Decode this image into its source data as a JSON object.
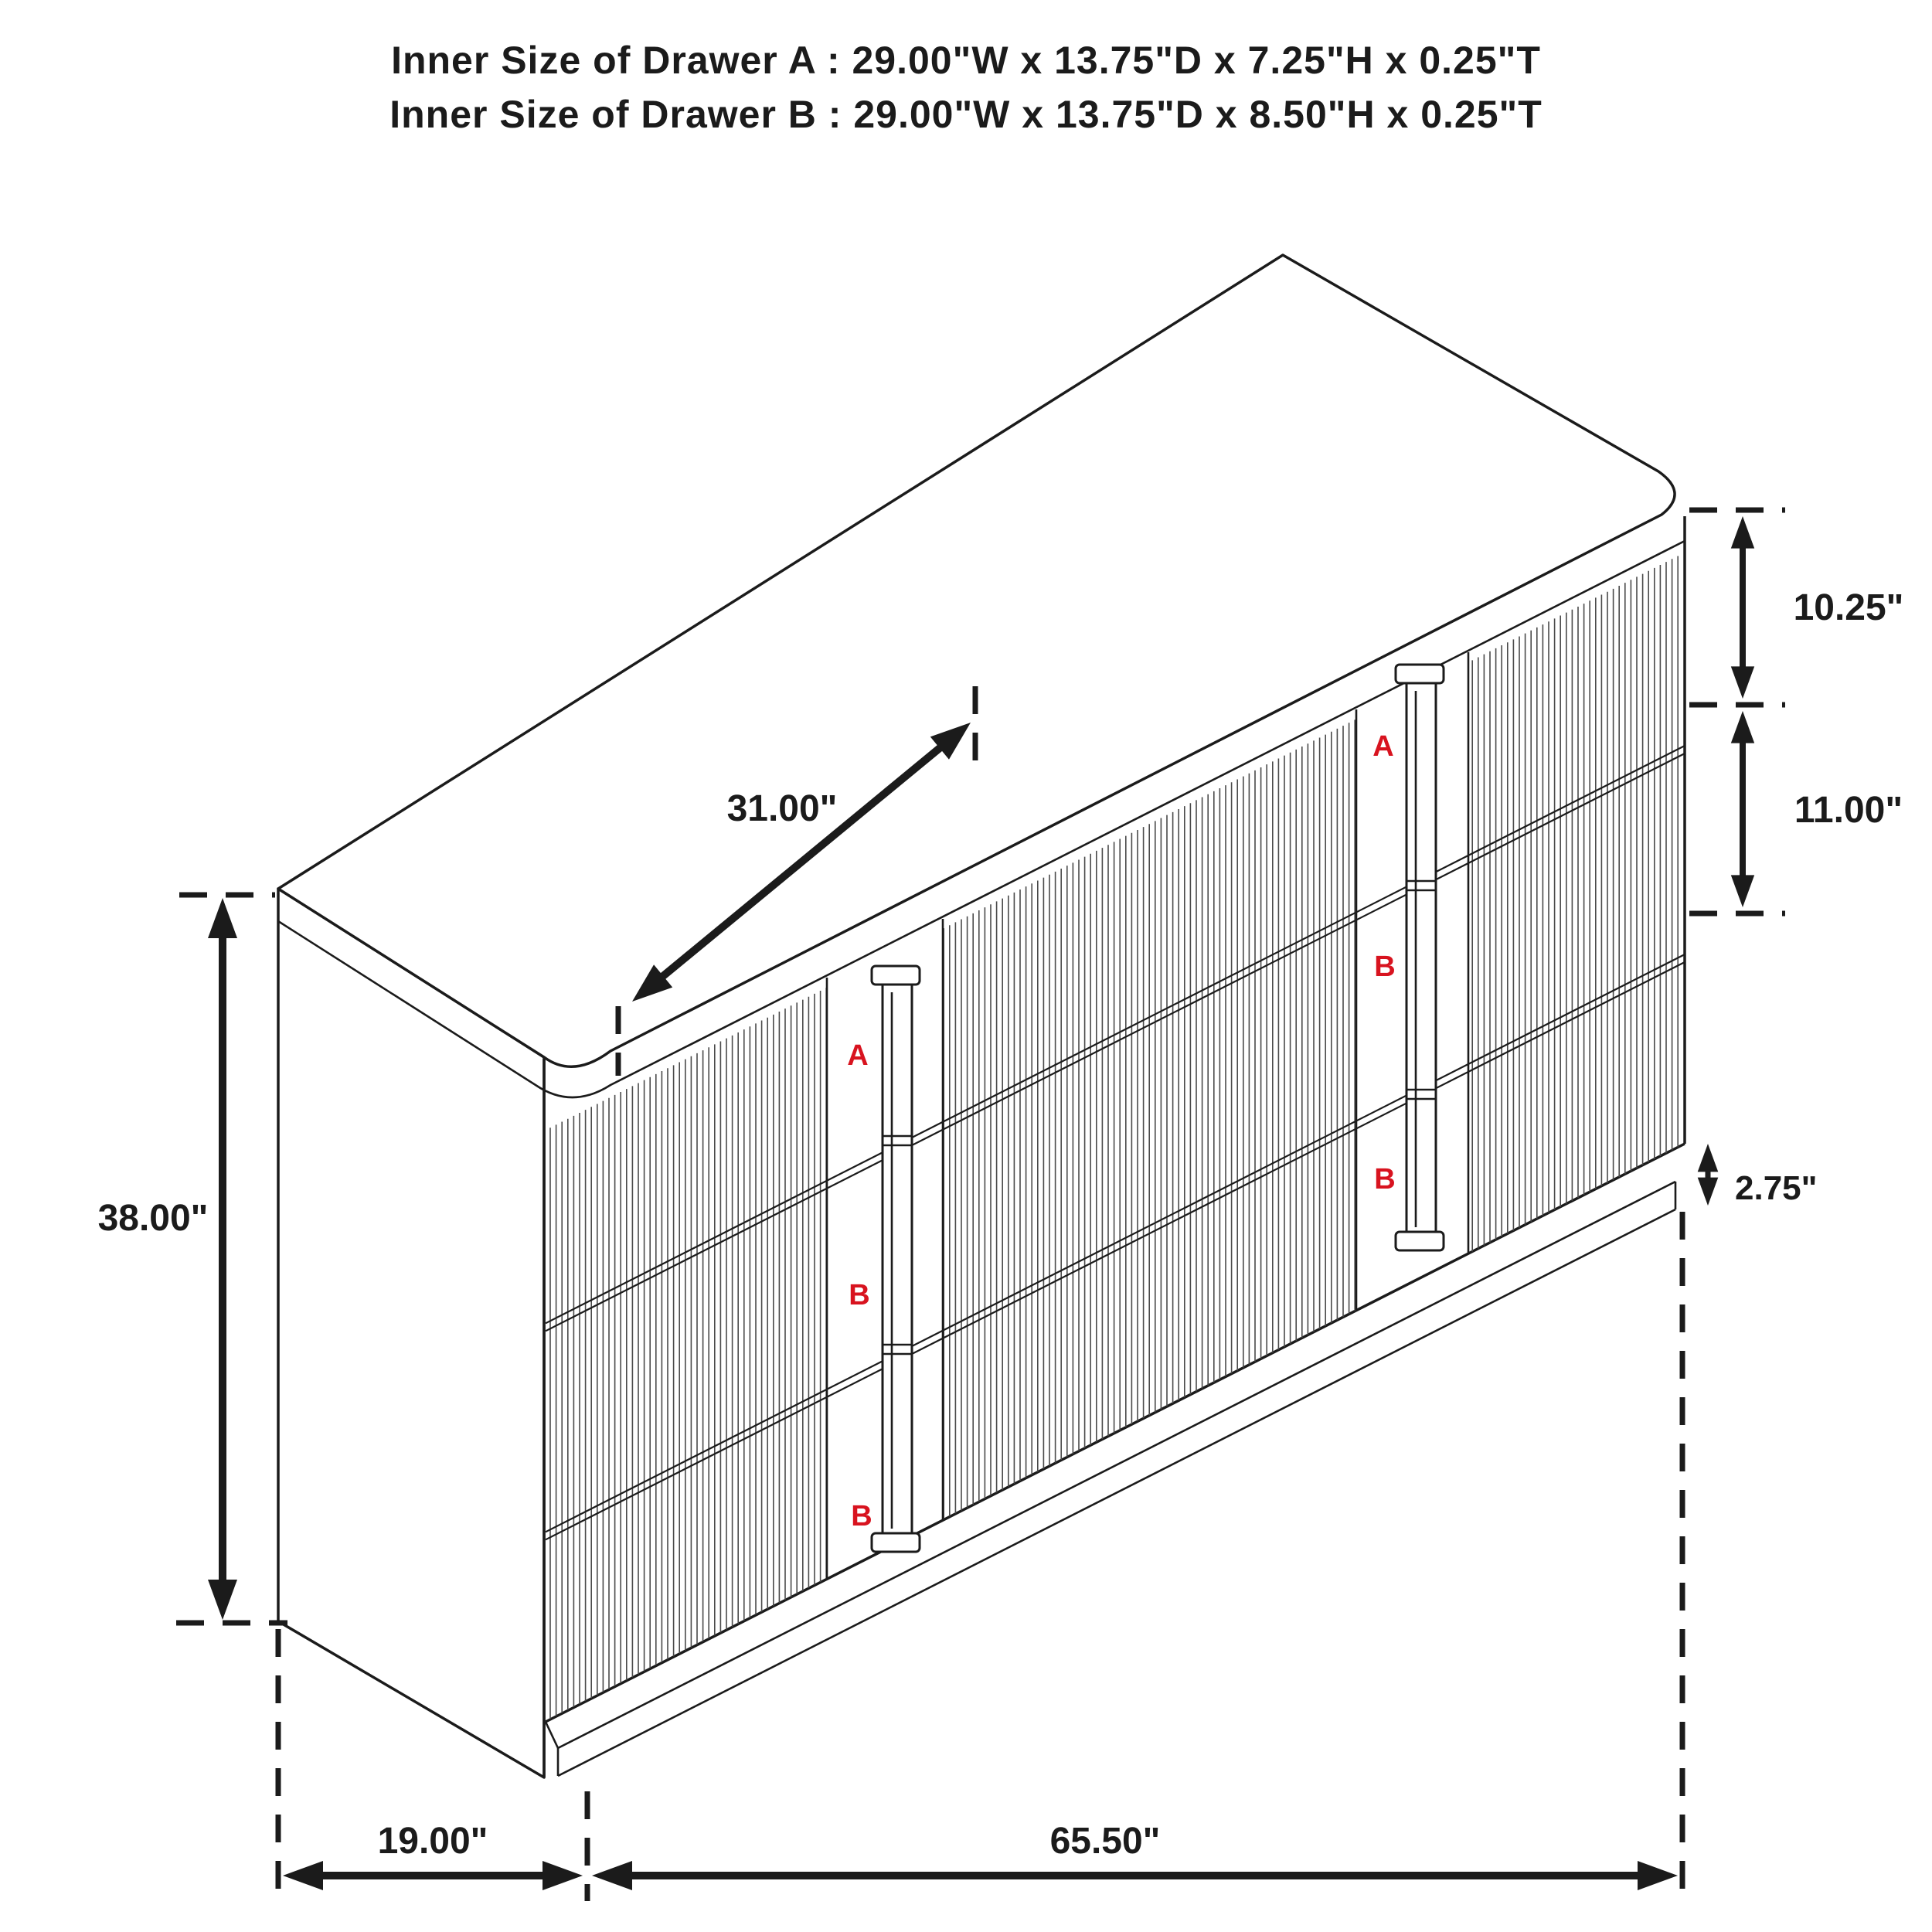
{
  "title": {
    "line1": "Inner Size of Drawer A : 29.00\"W x 13.75\"D x 7.25\"H x 0.25\"T",
    "line2": "Inner Size of Drawer B : 29.00\"W x 13.75\"D x 8.50\"H x 0.25\"T"
  },
  "dimensions": {
    "drawer_a_height": "10.25\"",
    "drawer_b_height": "11.00\"",
    "plinth_height": "2.75\"",
    "overall_height": "38.00\"",
    "middle_section_width": "31.00\"",
    "depth": "19.00\"",
    "overall_width": "65.50\""
  },
  "drawer_labels": {
    "left_column": [
      "A",
      "B",
      "B"
    ],
    "right_column": [
      "A",
      "B",
      "B"
    ]
  },
  "colors": {
    "line": "#1b1b1b",
    "flute": "#4a4a4a",
    "label_red": "#d8131f",
    "background": "#ffffff"
  }
}
